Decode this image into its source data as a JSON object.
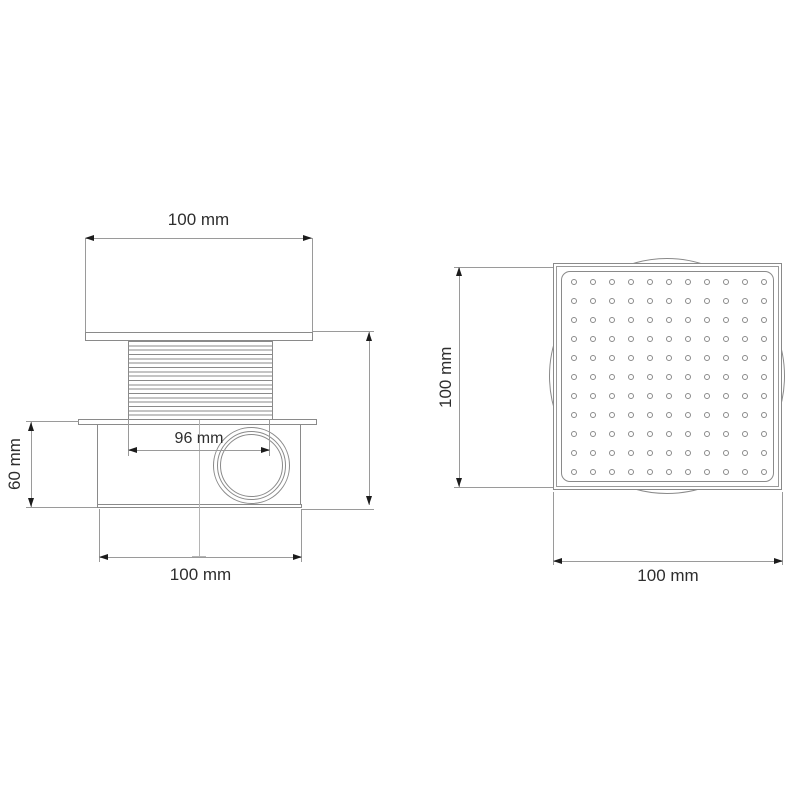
{
  "front_view": {
    "top_width_label": "100 mm",
    "thread_width_label": "96 mm",
    "body_height_label": "60 mm",
    "bottom_width_label": "100 mm"
  },
  "top_view": {
    "height_label": "100 mm",
    "width_label": "100 mm",
    "grate_rows": 11,
    "grate_cols": 11
  },
  "colors": {
    "line": "#8a8a8a",
    "dim_line": "#9a9a9a",
    "center_line": "#b5b5b5",
    "arrow": "#1c1c1c",
    "text": "#2e2e2e",
    "background": "#ffffff"
  }
}
